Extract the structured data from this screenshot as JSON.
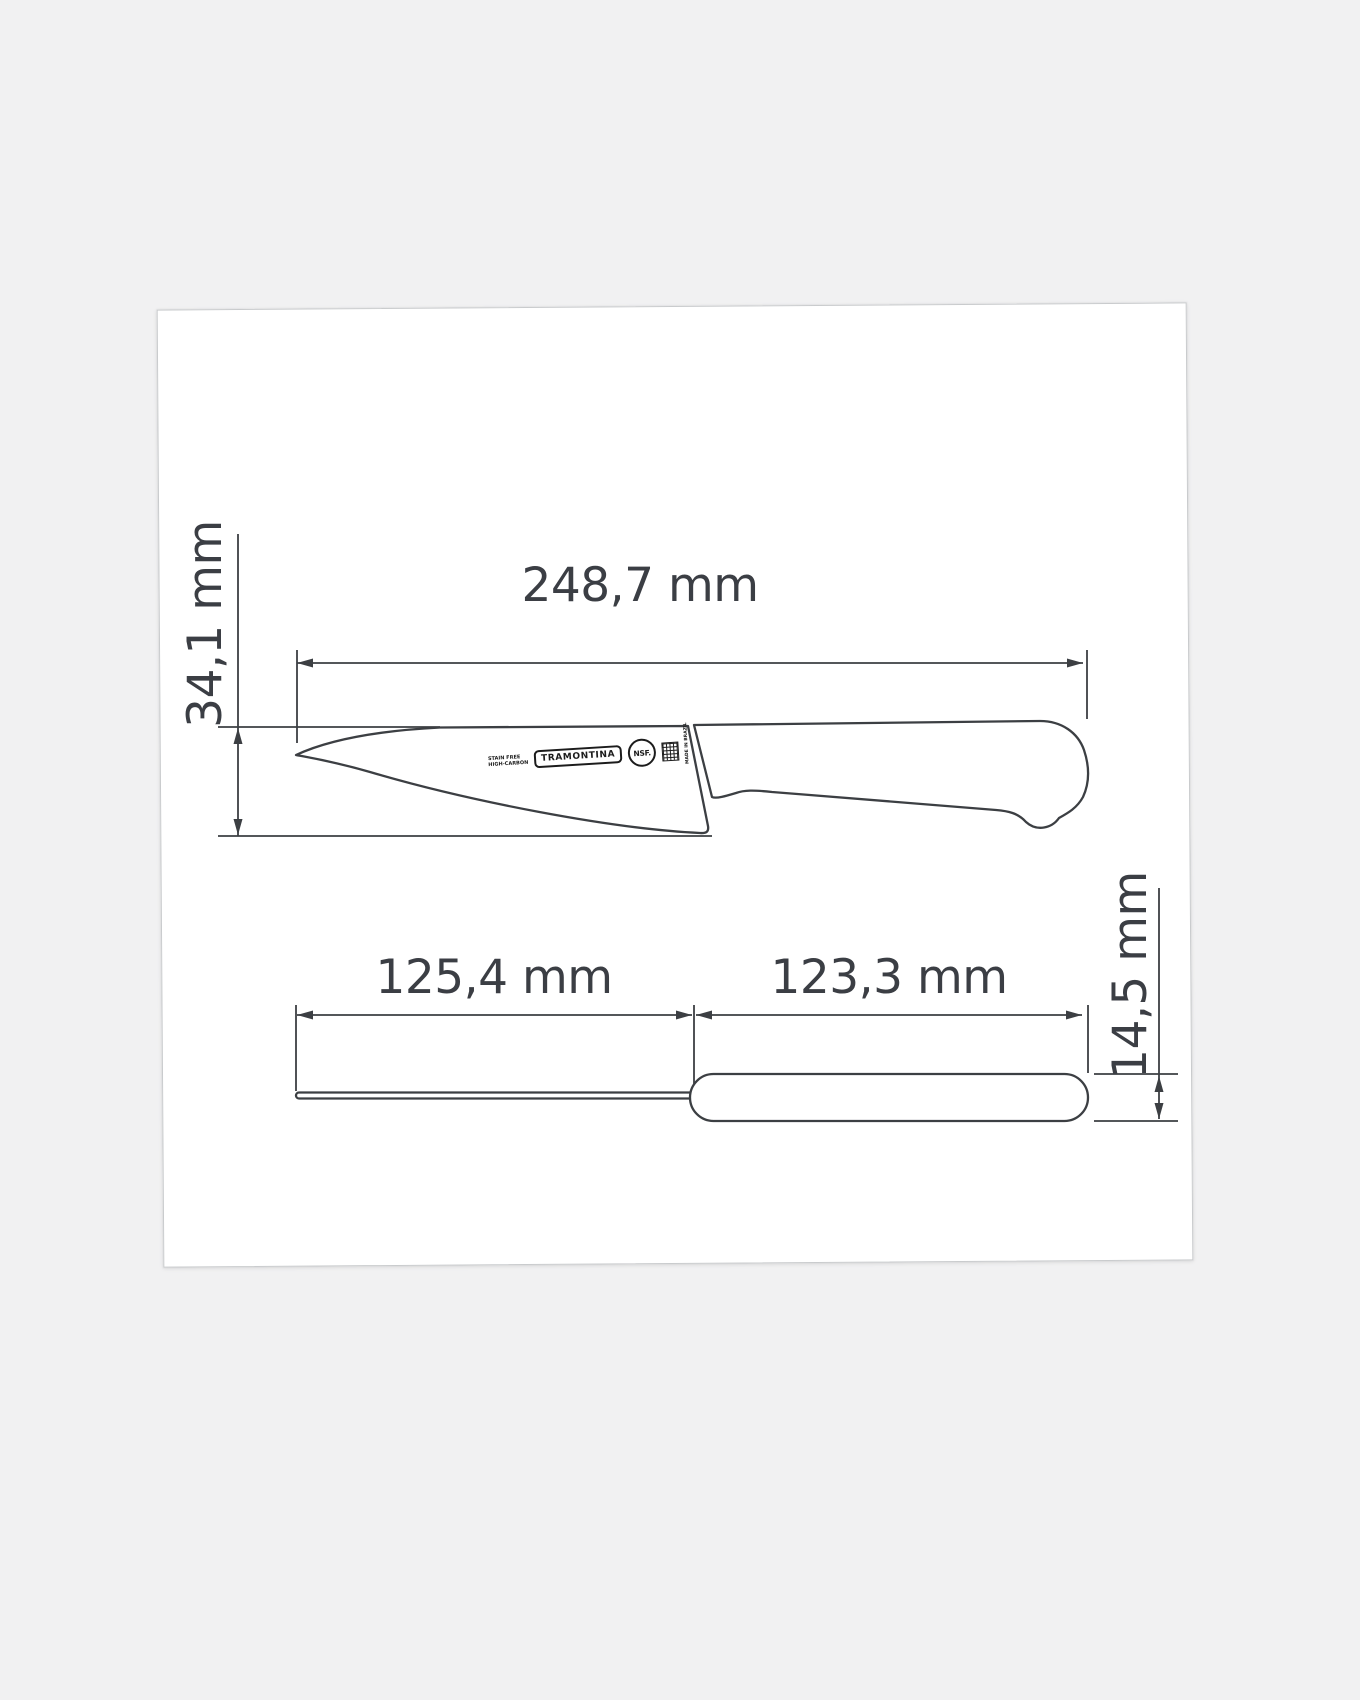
{
  "colors": {
    "background": "#f1f1f2",
    "card": "#ffffff",
    "line": "#3c3f43",
    "text": "#3b3e44"
  },
  "dimensions": {
    "total_length": "248,7 mm",
    "blade_height": "34,1 mm",
    "blade_length": "125,4 mm",
    "handle_length": "123,3 mm",
    "handle_thickness": "14,5 mm"
  },
  "blade_markings": {
    "steel_line1": "STAIN FREE",
    "steel_line2": "HIGH-CARBON",
    "brand": "TRAMONTINA",
    "certification": "NSF.",
    "origin": "MADE IN BRAZIL"
  }
}
